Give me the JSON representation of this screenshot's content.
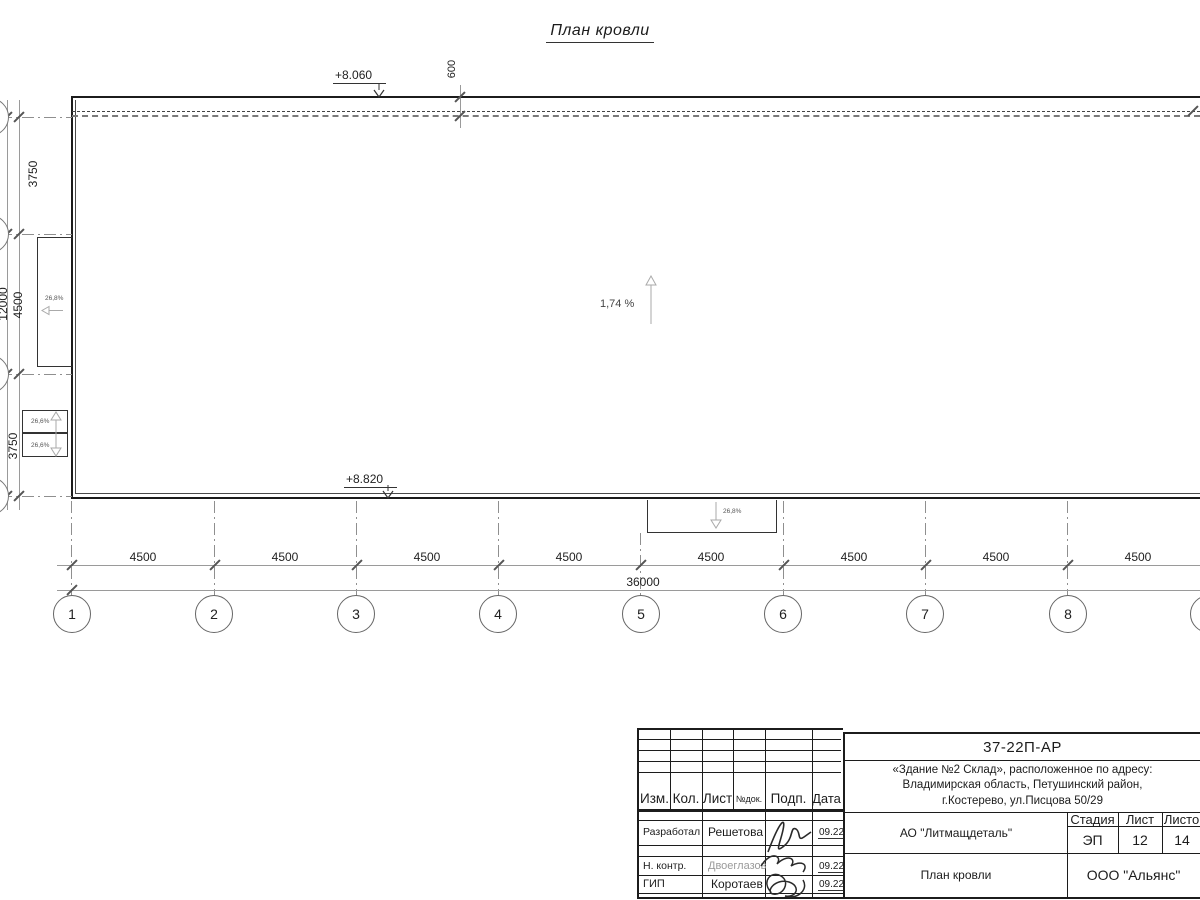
{
  "sheet_title": "План кровли",
  "drawing": {
    "elevation_top": "+8.060",
    "elevation_bottom": "+8.820",
    "parapet_offset": "600",
    "main_slope": "1,74 %",
    "left_canopy_slope": "26,8%",
    "left_lower_slope_1": "26,6%",
    "left_lower_slope_2": "26,6%",
    "bottom_canopy_slope": "26,8%",
    "bays": [
      "4500",
      "4500",
      "4500",
      "4500",
      "4500",
      "4500",
      "4500",
      "4500"
    ],
    "total_length": "36000",
    "axes": [
      "1",
      "2",
      "3",
      "4",
      "5",
      "6",
      "7",
      "8"
    ],
    "left_segments": [
      "3750",
      "4500",
      "3750"
    ],
    "left_total": "12000"
  },
  "title_block": {
    "doc_number": "37-22П-АР",
    "address_line_1": "«Здание №2 Склад», расположенное по адресу:",
    "address_line_2": "Владимирская область, Петушинский район,",
    "address_line_3": "г.Костерево, ул.Писцова 50/29",
    "rev_header": {
      "izm": "Изм.",
      "kol": "Кол.",
      "list": "Лист",
      "doc": "№док.",
      "podp": "Подп.",
      "data": "Дата"
    },
    "staff": [
      {
        "role": "Разработал",
        "name": "Решетова",
        "date": "09.22"
      },
      {
        "role": "Н. контр.",
        "name": "Двоеглазов",
        "date": "09.22"
      },
      {
        "role": "ГИП",
        "name": "Коротаев",
        "date": "09.22"
      }
    ],
    "customer": "АО \"Литмащдеталь\"",
    "stage_label": "Стадия",
    "sheet_label": "Лист",
    "sheets_label": "Листов",
    "stage": "ЭП",
    "sheet_no": "12",
    "sheets_total": "14",
    "drawing_name": "План кровли",
    "contractor": "ООО \"Альянс\""
  },
  "colors": {
    "line": "#1c1c1c",
    "dim": "#9a9a9a",
    "arrow": "#aaaaaa",
    "muted_text": "#9a9a9a"
  }
}
